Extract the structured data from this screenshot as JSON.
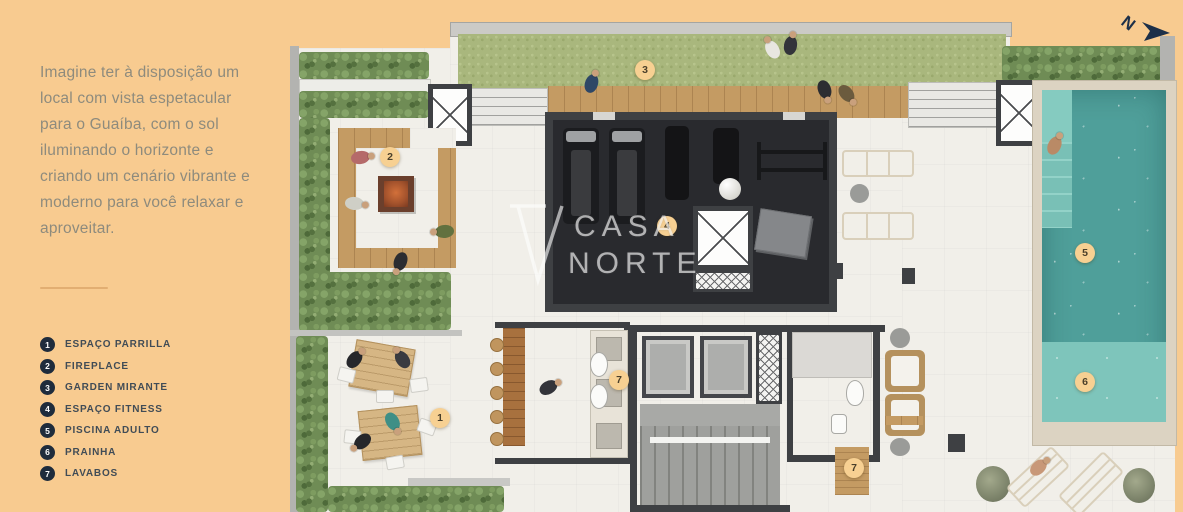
{
  "sidebar": {
    "paragraph": "Imagine ter à disposição um local com vista espetacular para o Guaíba, com o sol iluminando o horizonte e criando um cenário vibrante e moderno para você relaxar e aproveitar.",
    "legend": [
      {
        "num": "1",
        "label": "ESPAÇO PARRILLA"
      },
      {
        "num": "2",
        "label": "FIREPLACE"
      },
      {
        "num": "3",
        "label": "GARDEN MIRANTE"
      },
      {
        "num": "4",
        "label": "ESPAÇO FITNESS"
      },
      {
        "num": "5",
        "label": "PISCINA ADULTO"
      },
      {
        "num": "6",
        "label": "PRAINHA"
      },
      {
        "num": "7",
        "label": "LAVABOS"
      }
    ]
  },
  "plan": {
    "markers": [
      {
        "label": "1"
      },
      {
        "label": "2"
      },
      {
        "label": "3"
      },
      {
        "label": "4"
      },
      {
        "label": "5"
      },
      {
        "label": "6"
      },
      {
        "label": "7"
      },
      {
        "label": "7"
      }
    ],
    "watermark": {
      "line1": "CASA",
      "line2": "NORTE"
    },
    "compass_letter": "N"
  },
  "colors": {
    "background_peach": "#F8CB90",
    "text_gray": "#8E8B7D",
    "legend_navy": "#1F2C3C",
    "marker_peach": "#F7D092",
    "lawn_green": "#A9B77D",
    "hedge_green": "#6F8C55",
    "pool_teal": "#4F9F9A",
    "prainha_teal": "#7EC5BB",
    "wood": "#C49B63",
    "gym_floor": "#292A2E"
  }
}
